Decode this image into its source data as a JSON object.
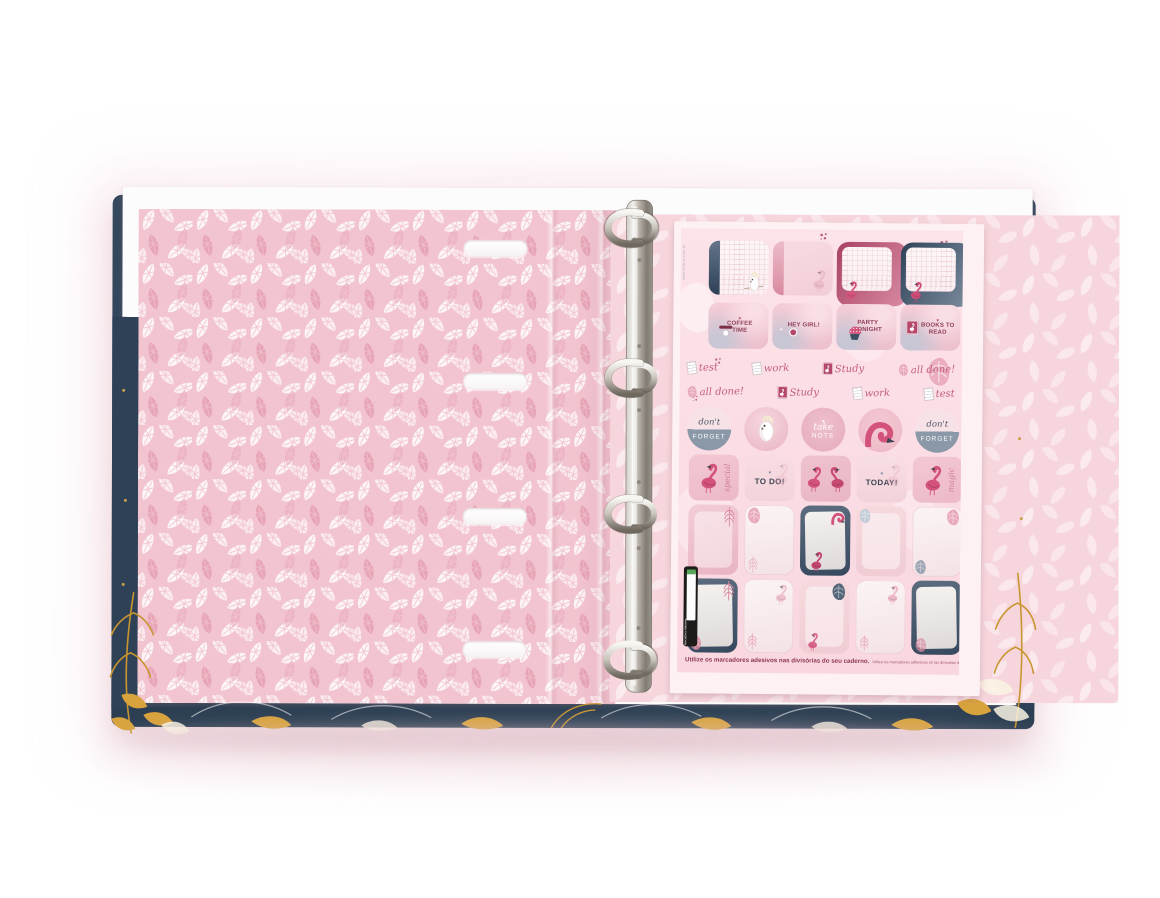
{
  "scene": {
    "description": "Open navy and pink flamingo-themed four-ring binder showing a leafy pink inner lining and a sheet of adhesive divider marker stickers",
    "heart_glyph": "♥"
  },
  "colors": {
    "cover_navy": "#2e4156",
    "inner_page_pink": "#f2c4cf",
    "right_page_pink": "#f6d6dc",
    "sheet_background": "#fbdde5",
    "accent_rose": "#b5476b",
    "script_rose": "#c4607d",
    "slate_blue": "#8795a6",
    "gold_leaf": "#c9952f",
    "metal_silver": "#b9b4ac"
  },
  "sticker_sheet": {
    "website_vertical_text": "www.tilibra.com.br",
    "badge_stickers": [
      {
        "icon": "coffee-cup-icon",
        "label": "COFFEE TIME"
      },
      {
        "icon": "camera-icon",
        "label": "HEY GIRL!"
      },
      {
        "icon": "cupcake-icon",
        "label": "PARTY TONIGHT"
      },
      {
        "icon": "book-flamingo-icon",
        "label": "BOOKS TO READ"
      }
    ],
    "script_word_row_1": [
      "test",
      "work",
      "Study",
      "all done!"
    ],
    "script_word_row_2": [
      "all done!",
      "Study",
      "work",
      "test"
    ],
    "round_stickers": {
      "dont_forget_script": "don't",
      "dont_forget_caps": "FORGET",
      "take_note_script": "take",
      "take_note_caps": "NOTE"
    },
    "square_stickers": {
      "special_script": "special",
      "to_do_label": "TO DO!",
      "today_label": "TODAY!",
      "magic_script": "magic"
    },
    "footer": {
      "portuguese": "Utilize os marcadores adesivos nas divisórias do seu caderno.",
      "spanish": "Utiliza los marcadores adhesivos en las divisorias de tu cuaderno."
    },
    "side_label": {
      "line_1": "Marcadores Adesivos",
      "line_2": "Marcadores Adhesivos"
    }
  }
}
